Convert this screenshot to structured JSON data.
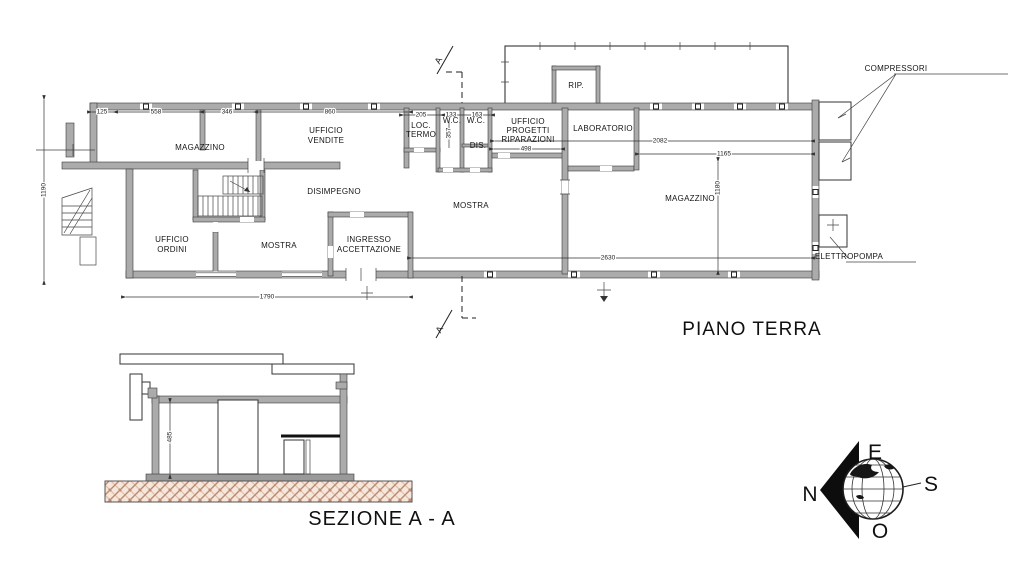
{
  "plan": {
    "title": "PIANO TERRA",
    "rooms": {
      "magazzino_left": "MAGAZZINO",
      "ufficio_vendite": [
        "UFFICIO",
        "VENDITE"
      ],
      "disimpegno": "DISIMPEGNO",
      "ufficio_ordini": [
        "UFFICIO",
        "ORDINI"
      ],
      "mostra_left": "MOSTRA",
      "ingresso_accettazione": [
        "INGRESSO",
        "ACCETTAZIONE"
      ],
      "loc_termo": [
        "LOC.",
        "TERMO"
      ],
      "wc1": "W.C.",
      "wc2": "W.C.",
      "dis": "DIS.",
      "rip": "RIP.",
      "ufficio_progetti": [
        "UFFICIO",
        "PROGETTI",
        "RIPARAZIONI"
      ],
      "laboratorio": "LABORATORIO",
      "mostra_center": "MOSTRA",
      "magazzino_right": "MAGAZZINO"
    },
    "equipment": {
      "compressori": "COMPRESSORI",
      "elettropompa": "ELETTROPOMPA"
    },
    "dimensions": {
      "d125": "125",
      "d558": "558",
      "d346": "346",
      "d860": "860",
      "d205": "205",
      "d133": "133",
      "d163": "163",
      "d357": "357",
      "d498": "498",
      "d2082": "2082",
      "d1165": "1165",
      "d1190": "1190",
      "d1180": "1180",
      "d2630": "2630",
      "d1790": "1790"
    },
    "section_marker": "A"
  },
  "section": {
    "title": "SEZIONE A - A",
    "dimensions": {
      "d485": "485"
    }
  },
  "compass": {
    "north": "N",
    "east": "E",
    "south": "S",
    "west": "O"
  },
  "colors": {
    "wall": "#ababab",
    "hatch": "#bd8a70",
    "line": "#222222"
  }
}
